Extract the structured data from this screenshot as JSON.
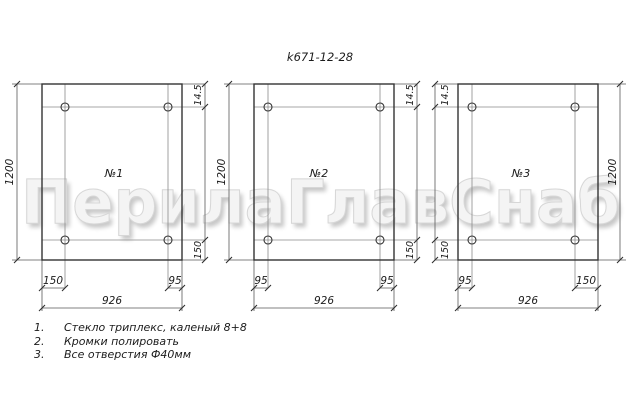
{
  "title": "k671-12-28",
  "watermark": "ПерилаГлавСнаб",
  "colors": {
    "line": "#343434",
    "thin_line": "#8a8a8a",
    "watermark_fill": "#f4f4f4",
    "watermark_shadow": "#c7c7c7",
    "background": "#ffffff"
  },
  "panels": [
    {
      "label": "№1",
      "height": "1200",
      "width": "926",
      "top_edge_to_hole": "14.5",
      "bottom_edge_to_hole": "150",
      "bottom_left_offset": "150",
      "bottom_right_offset": "95"
    },
    {
      "label": "№2",
      "height": "1200",
      "width": "926",
      "top_edge_to_hole": "14.5",
      "bottom_edge_to_hole": "150",
      "bottom_left_offset": "95",
      "bottom_right_offset": "95"
    },
    {
      "label": "№3",
      "height": "1200",
      "width": "926",
      "top_edge_to_hole": "14.5",
      "bottom_edge_to_hole": "150",
      "bottom_left_offset": "95",
      "bottom_right_offset": "150"
    }
  ],
  "notes": [
    {
      "num": "1.",
      "text": "Стекло триплекс, каленый 8+8"
    },
    {
      "num": "2.",
      "text": "Кромки полировать"
    },
    {
      "num": "3.",
      "text": "Все отверстия Ф40мм"
    }
  ]
}
